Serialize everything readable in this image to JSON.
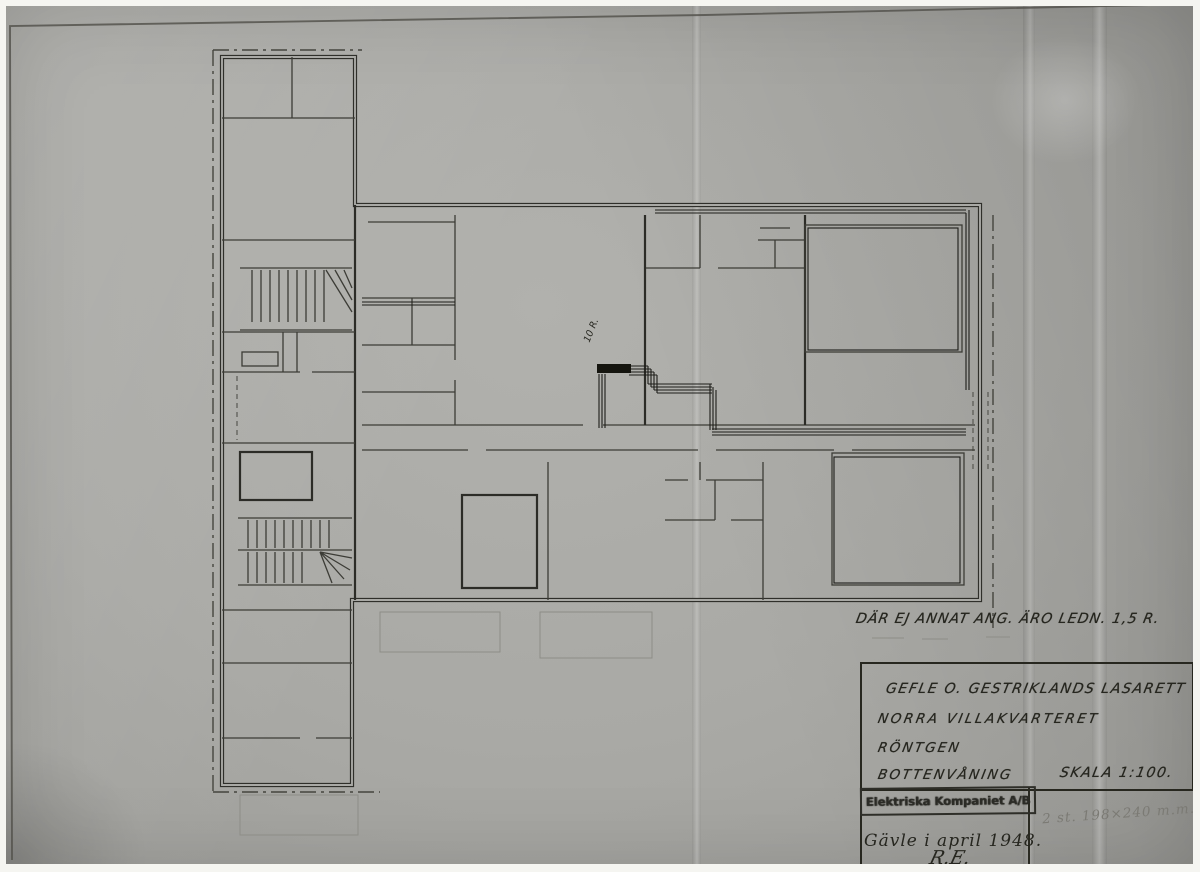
{
  "palette": {
    "photo_paper": "#a9a9a5",
    "photo_border": "#f5f5f1",
    "ink": "#26261f",
    "pencil": "#7b7a74"
  },
  "annotations": {
    "wiring_note": "DÄR EJ ANNAT ANG. ÄRO LEDN. 1,5 R.",
    "conduit_size_label": "10 R.",
    "pencil_note": "2 st. 198×240 m.m."
  },
  "title_block": {
    "hospital": "GEFLE O. GESTRIKLANDS LASARETT",
    "quarter": "NORRA VILLAKVARTERET",
    "department": "RÖNTGEN",
    "floor": "BOTTENVÅNING",
    "scale": "SKALA 1:100.",
    "stamp": "Elektriska Kompaniet A/B",
    "place_date": "Gävle i april 1948.",
    "signature": "R.E."
  }
}
